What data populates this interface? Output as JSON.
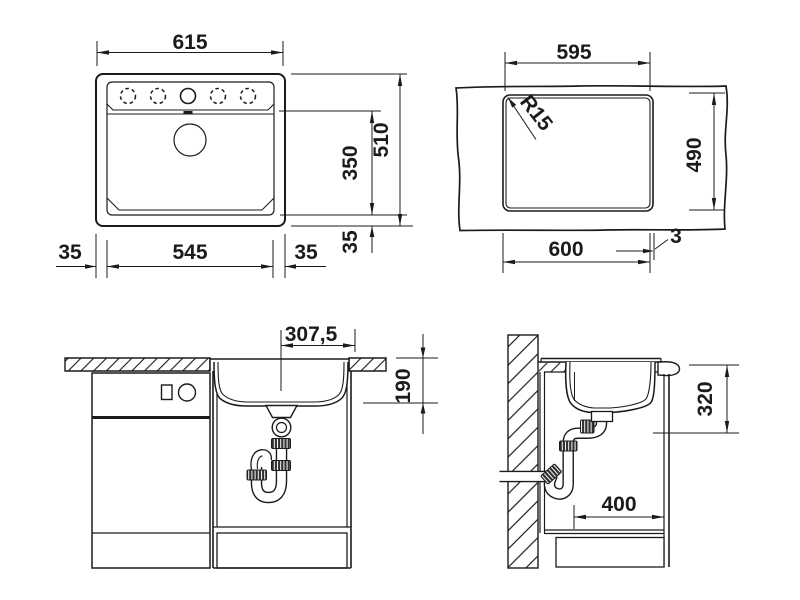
{
  "drawing": {
    "type": "sink-installation-technical-drawing",
    "colors": {
      "line": "#1b1b1b",
      "background": "#ffffff"
    },
    "dims": {
      "top": {
        "width": "615",
        "bowl_width": "545",
        "rim_left": "35",
        "rim_right": "35",
        "rim_bottom": "35",
        "depth": "510",
        "bowl_depth": "350"
      },
      "cutout": {
        "width": "595",
        "height": "490",
        "cut_width": "600",
        "edge_gap": "3",
        "corner_radius": "R15"
      },
      "front": {
        "center_offset": "307,5",
        "bowl_depth": "190"
      },
      "side": {
        "install_depth": "320",
        "clearance_depth": "400"
      }
    }
  }
}
